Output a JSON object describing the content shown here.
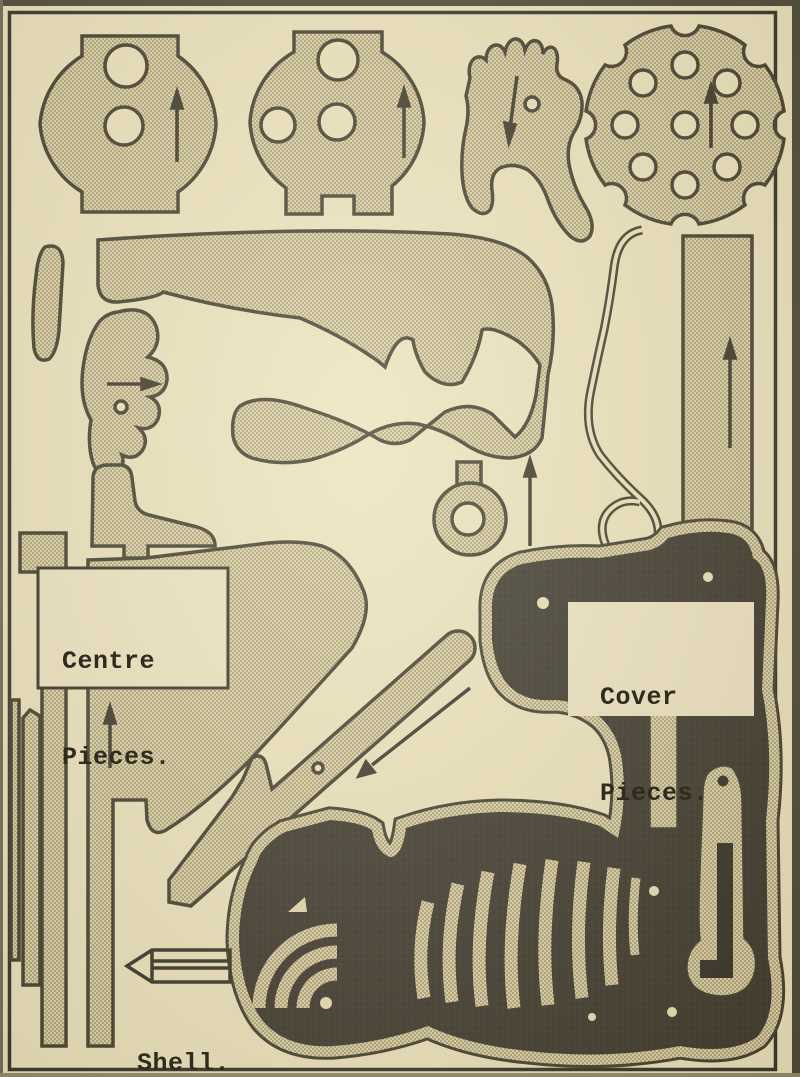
{
  "sheet": {
    "kind": "toy revolver cut-out pattern sheet",
    "labels": {
      "centre": {
        "line1": "Centre",
        "line2": "Pieces."
      },
      "cover": {
        "line1": "Cover",
        "line2": "Pieces."
      },
      "shell": {
        "text": "Shell."
      }
    },
    "colors": {
      "paper": "#ebe1bc",
      "piece_fill_base": "#dcd0a2",
      "stipple_dot": "#756b52",
      "outline": "#3a3626",
      "cover_black": "#343026",
      "label_panel": "#ece2c1",
      "page_border": "#2b2920"
    },
    "pieces": [
      {
        "name": "side-plate-disc-left",
        "marks": "2 holes, up arrow"
      },
      {
        "name": "side-plate-disc-right",
        "marks": "3 holes, up arrow"
      },
      {
        "name": "hammer-blank",
        "marks": "1 hole, down arrow"
      },
      {
        "name": "cylinder-face",
        "marks": "9 holes, up arrow"
      },
      {
        "name": "curved-spacer-bar"
      },
      {
        "name": "frame-blank"
      },
      {
        "name": "pawl-blank",
        "marks": "1 hole, right arrow"
      },
      {
        "name": "heel-block"
      },
      {
        "name": "ring-with-stem",
        "marks": "1 hole, up arrow"
      },
      {
        "name": "mainspring-wire"
      },
      {
        "name": "barrel-strip",
        "marks": "up arrow"
      },
      {
        "name": "centre-frame-strips",
        "marks": "up arrow"
      },
      {
        "name": "barrel-rib",
        "marks": "1 hole, diagonal arrow"
      },
      {
        "name": "cover-sheet",
        "marks": "grip stripes, gate piece, rivet holes"
      },
      {
        "name": "shell-bullet-outline"
      }
    ],
    "grain_arrows": [
      "up",
      "up",
      "down",
      "up",
      "right",
      "up",
      "up",
      "up",
      "diagonal-down-left"
    ]
  }
}
